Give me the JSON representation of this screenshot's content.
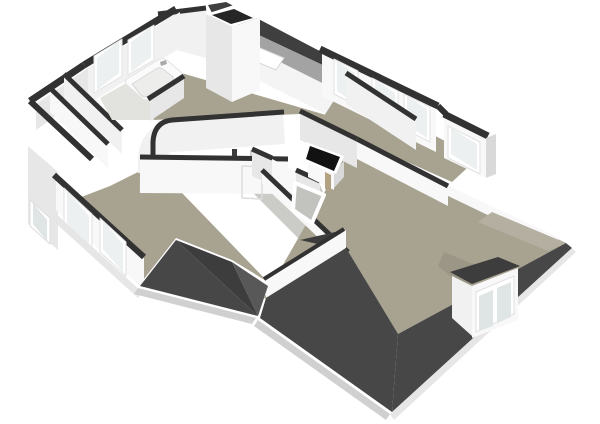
{
  "meta": {
    "view": "3d-floorplan-render",
    "storey": "attic-floor",
    "background": "#ffffff",
    "canvas": {
      "width": 600,
      "height": 424
    }
  },
  "palette": {
    "bg": "#ffffff",
    "cap": "#323232",
    "roofSliver": "#3f3f3f",
    "slopeInner": "#a3a3a3",
    "kneeWall": "#f4f4f4",
    "floor": "#a8a290",
    "floorDim": "#9c9686",
    "floorLight": "#b5afa1",
    "landingFloor": "#cbcbc8",
    "voidFill": "#c2c2bf",
    "wallBright": "#f8f8f8",
    "wallFace": "#f1f1f1",
    "wallMid": "#e7e7e7",
    "wallShade": "#d9d9d9",
    "glass": "#edf0f0",
    "glassDim": "#dfe4e4",
    "frame": "#ffffff",
    "roofA": "#474747",
    "roofB": "#3d3d3d",
    "roofC": "#585858",
    "fascia": "#d0d0d0",
    "fasciaLight": "#e6e6e6",
    "black": "#121212",
    "wood": "#b2a283",
    "bathFloor": "#e2e2df",
    "tub": "#fbfbfb",
    "tubInner": "#ededec",
    "metal": "#a9a9a9"
  },
  "scene": {
    "elements": [
      {
        "name": "roof-ridge-sliver",
        "shape": "polygon",
        "points": "208,5 226,2 354,69 346,76 212,13",
        "fill": "$roofSliver"
      },
      {
        "name": "ceiling-slope-band",
        "shape": "polygon",
        "points": "212,13 346,76 336,90 204,24",
        "fill": "$slopeInner"
      },
      {
        "name": "knee-wall",
        "shape": "polygon",
        "points": "204,24 336,90 330,116 198,50",
        "fill": "$kneeWall"
      },
      {
        "name": "skylight-window",
        "shape": "polygon",
        "points": "246,42 284,58 276,70 238,54",
        "fill": "$frame",
        "stroke": "#d5d5d5",
        "strokeWidth": 1
      },
      {
        "name": "bedroom-floor",
        "shape": "polygon",
        "points": "140,61 326,115 356,137 352,142 300,114 152,120",
        "fill": "$floor"
      },
      {
        "name": "rightwing-floor",
        "shape": "polygon",
        "points": "342,88 478,158 452,182 358,140 324,116",
        "fill": "$floor"
      },
      {
        "name": "landing-floor",
        "shape": "polygon",
        "points": "250,150 320,185 336,222 298,238 252,192",
        "fill": "$landingFloor"
      },
      {
        "name": "bottomleft-room-floor",
        "shape": "polygon",
        "points": "58,206 110,186 154,164 268,282 232,260 176,238 140,284",
        "fill": "$floor"
      },
      {
        "name": "bigroom-floor",
        "shape": "polygon",
        "points": "352,144 448,186 566,243 398,334 264,298",
        "fill": "$floor"
      },
      {
        "name": "topwing-wall-face",
        "shape": "polygon",
        "points": "162,12 206,7 206,58 162,46",
        "fill": "$wallFace"
      },
      {
        "name": "topwing-wall-cap",
        "shape": "path",
        "d": "M 158,14 L 206,8",
        "fill": "none",
        "stroke": "$cap",
        "strokeWidth": 5
      },
      {
        "name": "bath-window-wall-face",
        "shape": "polygon",
        "points": "88,68 180,12 180,48 88,104",
        "fill": "$wallFace"
      },
      {
        "name": "bath-window-wall-cap",
        "shape": "path",
        "d": "M 84,65 L 176,9",
        "fill": "none",
        "stroke": "$cap",
        "strokeWidth": 7
      },
      {
        "name": "bath-window-1-frame",
        "shape": "polygon",
        "points": "94,56 122,39 122,76 94,93",
        "fill": "$frame",
        "stroke": "#e2e2e2",
        "strokeWidth": 1
      },
      {
        "name": "bath-window-1-glass",
        "shape": "polygon",
        "points": "97,58 119,41 119,73 97,90",
        "fill": "$glass"
      },
      {
        "name": "bath-window-2-frame",
        "shape": "polygon",
        "points": "128,40 154,25 154,60 128,75",
        "fill": "$frame",
        "stroke": "#e2e2e2",
        "strokeWidth": 1
      },
      {
        "name": "bath-window-2-glass",
        "shape": "polygon",
        "points": "131,42 151,27 151,57 131,72",
        "fill": "$glass"
      },
      {
        "name": "nw-corner-wall-face",
        "shape": "polygon",
        "points": "36,104 88,68 88,94 36,130",
        "fill": "$wallMid"
      },
      {
        "name": "nw-corner-wall-cap",
        "shape": "path",
        "d": "M 30,101 L 84,65",
        "fill": "none",
        "stroke": "$cap",
        "strokeWidth": 7
      },
      {
        "name": "leftwing-outer-cap",
        "shape": "path",
        "d": "M 30,101 L 92,159",
        "fill": "none",
        "stroke": "$cap",
        "strokeWidth": 6
      },
      {
        "name": "leftwing-wall-1-face",
        "shape": "polygon",
        "points": "50,90 108,146 108,168 50,112",
        "fill": "$wallBright"
      },
      {
        "name": "leftwing-wall-1-cap",
        "shape": "path",
        "d": "M 50,88 L 108,144",
        "fill": "none",
        "stroke": "$cap",
        "strokeWidth": 5
      },
      {
        "name": "leftwing-wall-2-face",
        "shape": "polygon",
        "points": "64,76 122,132 122,154 64,98",
        "fill": "$wallFace"
      },
      {
        "name": "leftwing-wall-2-cap",
        "shape": "path",
        "d": "M 64,74 L 122,130",
        "fill": "none",
        "stroke": "$cap",
        "strokeWidth": 5
      },
      {
        "name": "left-gable-face",
        "shape": "polygon",
        "points": "28,146 58,172 58,250 28,224",
        "fill": "$wallMid"
      },
      {
        "name": "left-gable-window-frame",
        "shape": "polygon",
        "points": "30,200 50,218 50,244 30,226",
        "fill": "$frame",
        "stroke": "#dcdcdc",
        "strokeWidth": 1
      },
      {
        "name": "left-gable-window-glass",
        "shape": "polygon",
        "points": "33,203 47,220 47,241 33,224",
        "fill": "$glassDim"
      },
      {
        "name": "chimney-top-rim",
        "shape": "polygon",
        "points": "206,14 234,5 260,17 232,27",
        "fill": "$frame"
      },
      {
        "name": "chimney-shaft-opening",
        "shape": "polygon",
        "points": "212,15 234,9 253,18 231,24",
        "fill": "#262626"
      },
      {
        "name": "chimney-left-face",
        "shape": "polygon",
        "points": "206,14 232,27 232,102 206,88",
        "fill": "$wallMid"
      },
      {
        "name": "chimney-right-face",
        "shape": "polygon",
        "points": "232,27 260,17 260,90 232,102",
        "fill": "$wallBright"
      },
      {
        "name": "ne-wall-face-1",
        "shape": "polygon",
        "points": "322,54 436,110 436,152 322,96",
        "fill": "$wallBright"
      },
      {
        "name": "ne-wall-cap-1",
        "shape": "path",
        "d": "M 320,49 L 438,106",
        "fill": "none",
        "stroke": "$cap",
        "strokeWidth": 7
      },
      {
        "name": "ne-window-1-frame",
        "shape": "polygon",
        "points": "334,59 358,71 358,106 334,94",
        "fill": "$frame",
        "stroke": "#e2e2e2",
        "strokeWidth": 1
      },
      {
        "name": "ne-window-1-glass",
        "shape": "polygon",
        "points": "337,61 355,73 355,103 337,91",
        "fill": "$glass"
      },
      {
        "name": "ne-window-2-frame",
        "shape": "polygon",
        "points": "372,78 398,91 398,126 372,113",
        "fill": "$frame",
        "stroke": "#e2e2e2",
        "strokeWidth": 1
      },
      {
        "name": "ne-window-2-glass",
        "shape": "polygon",
        "points": "375,80 395,93 395,122 375,109",
        "fill": "$glass"
      },
      {
        "name": "ne-window-3-frame",
        "shape": "polygon",
        "points": "404,94 430,107 430,142 404,129",
        "fill": "$frame",
        "stroke": "#e2e2e2",
        "strokeWidth": 1
      },
      {
        "name": "ne-window-3-glass",
        "shape": "polygon",
        "points": "407,96 427,109 427,138 407,125",
        "fill": "$glass"
      },
      {
        "name": "ne-wall-jog-cap",
        "shape": "path",
        "d": "M 438,106 L 446,114",
        "fill": "none",
        "stroke": "$cap",
        "strokeWidth": 6
      },
      {
        "name": "ne-wall-face-2",
        "shape": "polygon",
        "points": "444,118 486,138 486,178 444,158",
        "fill": "$wallBright"
      },
      {
        "name": "ne-wall-cap-2",
        "shape": "path",
        "d": "M 444,114 L 488,136",
        "fill": "none",
        "stroke": "$cap",
        "strokeWidth": 7
      },
      {
        "name": "ne-window-4-frame",
        "shape": "polygon",
        "points": "448,126 480,142 480,174 448,158",
        "fill": "$frame",
        "stroke": "#e2e2e2",
        "strokeWidth": 1
      },
      {
        "name": "ne-window-4-glass",
        "shape": "polygon",
        "points": "451,128 477,144 477,170 451,154",
        "fill": "$glass"
      },
      {
        "name": "ne-end-wall-face",
        "shape": "polygon",
        "points": "486,138 496,134 496,174 486,178",
        "fill": "$wallShade"
      },
      {
        "name": "rightwing-divider-1-face",
        "shape": "polygon",
        "points": "300,113 357,141 357,168 300,140",
        "fill": "$wallMid"
      },
      {
        "name": "rightwing-divider-1-cap",
        "shape": "path",
        "d": "M 300,111 L 357,139",
        "fill": "none",
        "stroke": "$cap",
        "strokeWidth": 5
      },
      {
        "name": "rightwing-divider-2-face",
        "shape": "polygon",
        "points": "346,75 416,121 416,150 346,104",
        "fill": "$wallFace"
      },
      {
        "name": "rightwing-divider-2-cap",
        "shape": "path",
        "d": "M 346,73 L 416,119",
        "fill": "none",
        "stroke": "$cap",
        "strokeWidth": 5
      },
      {
        "name": "bigroom-north-wall-face",
        "shape": "polygon",
        "points": "357,141 448,188 448,206 357,159",
        "fill": "$wallBright"
      },
      {
        "name": "bigroom-north-wall-cap",
        "shape": "path",
        "d": "M 357,139 L 448,186",
        "fill": "none",
        "stroke": "$cap",
        "strokeWidth": 5
      },
      {
        "name": "bigroom-ne-low-wall",
        "shape": "polygon",
        "points": "448,186 560,238 552,246 444,194",
        "fill": "$wallBright"
      },
      {
        "name": "roof-right-wedge",
        "shape": "polygon",
        "points": "492,212 566,243 548,251 478,222",
        "fill": "$floorLight"
      },
      {
        "name": "corridor-wall-1-face",
        "shape": "path",
        "d": "M 284,129 L 172,137 Q 154,139 153,159 L 153,173",
        "fill": "none",
        "stroke": "$wallFace",
        "strokeWidth": 30
      },
      {
        "name": "corridor-wall-1-cap",
        "shape": "path",
        "d": "M 284,112 L 172,120 Q 154,122 153,142 L 153,156",
        "fill": "none",
        "stroke": "$cap",
        "strokeWidth": 5
      },
      {
        "name": "corridor-wall-2-face",
        "shape": "path",
        "d": "M 140,176 L 288,177",
        "fill": "none",
        "stroke": "$wallBright",
        "strokeWidth": 34
      },
      {
        "name": "corridor-wall-2-cap",
        "shape": "path",
        "d": "M 140,157 L 288,159",
        "fill": "none",
        "stroke": "$cap",
        "strokeWidth": 5
      },
      {
        "name": "corridor-door-outline",
        "shape": "polygon",
        "points": "242,166 262,167 262,199 242,198",
        "fill": "none",
        "stroke": "#dcdcdc",
        "strokeWidth": 1.5
      },
      {
        "name": "door-handle-mark",
        "shape": "polygon",
        "points": "232,149 237,149 237,156 232,156",
        "fill": "#3a3a3a"
      },
      {
        "name": "landing-nw-wall-face",
        "shape": "polygon",
        "points": "252,151 320,183 320,208 252,176",
        "fill": "$wallMid"
      },
      {
        "name": "landing-door-gap",
        "shape": "polygon",
        "points": "272,159 296,171 296,196 272,184",
        "fill": "$wallBright"
      },
      {
        "name": "landing-nw-wall-cap-a",
        "shape": "path",
        "d": "M 252,149 L 272,158",
        "fill": "none",
        "stroke": "$cap",
        "strokeWidth": 5
      },
      {
        "name": "landing-nw-wall-cap-b",
        "shape": "path",
        "d": "M 296,170 L 320,181",
        "fill": "none",
        "stroke": "$cap",
        "strokeWidth": 5
      },
      {
        "name": "landing-east-wall-face",
        "shape": "polygon",
        "points": "262,172 348,254 348,266 262,184",
        "fill": "$wallBright"
      },
      {
        "name": "landing-east-wall-cap",
        "shape": "path",
        "d": "M 262,170 L 348,252",
        "fill": "none",
        "stroke": "$cap",
        "strokeWidth": 5
      },
      {
        "name": "middle-roof-triangle",
        "shape": "polygon",
        "points": "300,240 344,250 344,230",
        "fill": "$roofB"
      },
      {
        "name": "bigroom-west-wall-face",
        "shape": "polygon",
        "points": "266,280 346,230 346,248 266,298",
        "fill": "$wallBright"
      },
      {
        "name": "bigroom-west-wall-cap",
        "shape": "path",
        "d": "M 264,279 L 344,229",
        "fill": "none",
        "stroke": "$cap",
        "strokeWidth": 4
      },
      {
        "name": "bathroom-floor",
        "shape": "polygon",
        "points": "100,98 128,82 154,104 154,120 112,120",
        "fill": "$bathFloor"
      },
      {
        "name": "bathtub-outer",
        "shape": "path",
        "d": "M 126,84 Q 124,80 130,77 L 158,60 Q 164,57 168,61 L 182,73 Q 186,77 180,81 L 152,99 Q 146,102 142,98 Z",
        "fill": "$tub",
        "stroke": "#e3e3e3",
        "strokeWidth": 1
      },
      {
        "name": "bathtub-basin",
        "shape": "path",
        "d": "M 132,84 L 156,69 Q 160,66 164,70 L 172,76 Q 175,79 171,82 L 148,96 Q 144,98 141,95 Z",
        "fill": "$tubInner",
        "stroke": "#d8d8d8",
        "strokeWidth": 1
      },
      {
        "name": "bathtub-faucet",
        "shape": "polygon",
        "points": "160,62 166,60 167,64 161,66",
        "fill": "$metal"
      },
      {
        "name": "bath-divider-face",
        "shape": "polygon",
        "points": "150,101 184,78 184,98 150,121",
        "fill": "$wallMid"
      },
      {
        "name": "bath-divider-cap",
        "shape": "path",
        "d": "M 148,99 L 184,76",
        "fill": "none",
        "stroke": "$cap",
        "strokeWidth": 5
      },
      {
        "name": "stair-hatch-front-face",
        "shape": "polygon",
        "points": "308,159 334,172 334,190 308,177",
        "fill": "$wallBright"
      },
      {
        "name": "stair-hatch-side-face",
        "shape": "polygon",
        "points": "334,172 344,161 344,177 334,188",
        "fill": "$wallShade"
      },
      {
        "name": "stair-hatch-rim",
        "shape": "polygon",
        "points": "306,142 344,156 336,174 302,160",
        "fill": "$frame"
      },
      {
        "name": "stair-hatch-opening",
        "shape": "polygon",
        "points": "310,146 340,157 334,171 306,159",
        "fill": "$black"
      },
      {
        "name": "stair-hatch-post",
        "shape": "polygon",
        "points": "325,172 331,175 331,192 325,189",
        "fill": "$wood"
      },
      {
        "name": "stair-void-frame",
        "shape": "polygon",
        "points": "295,183 324,195 312,223 293,210",
        "fill": "$voidFill",
        "stroke": "$frame",
        "strokeWidth": 4
      },
      {
        "name": "sw-window-wall-face",
        "shape": "polygon",
        "points": "56,178 144,258 144,290 56,210",
        "fill": "$wallBright"
      },
      {
        "name": "sw-window-wall-cap",
        "shape": "path",
        "d": "M 54,175 L 144,257",
        "fill": "none",
        "stroke": "$cap",
        "strokeWidth": 6
      },
      {
        "name": "sw-window-1-frame",
        "shape": "polygon",
        "points": "64,188 92,214 92,252 64,226",
        "fill": "$frame",
        "stroke": "#e0e0e0",
        "strokeWidth": 1
      },
      {
        "name": "sw-window-1-glass",
        "shape": "polygon",
        "points": "67,191 89,216 89,248 67,223",
        "fill": "$glass"
      },
      {
        "name": "sw-window-2-frame",
        "shape": "polygon",
        "points": "100,218 126,242 126,276 100,252",
        "fill": "$frame",
        "stroke": "#e0e0e0",
        "strokeWidth": 1
      },
      {
        "name": "sw-window-2-glass",
        "shape": "polygon",
        "points": "103,221 123,244 123,272 103,249",
        "fill": "$glass"
      },
      {
        "name": "sw-eave-fascia",
        "shape": "polygon",
        "points": "54,212 142,292 138,298 50,218",
        "fill": "$fasciaLight"
      },
      {
        "name": "roof-bl-facet-1",
        "shape": "polygon",
        "points": "140,286 176,240 258,316",
        "fill": "$roofA"
      },
      {
        "name": "roof-bl-facet-2",
        "shape": "polygon",
        "points": "176,240 232,262 258,316",
        "fill": "$roofB"
      },
      {
        "name": "roof-bl-facet-3",
        "shape": "polygon",
        "points": "232,262 268,286 258,316",
        "fill": "$roofC"
      },
      {
        "name": "roof-bl-fascia",
        "shape": "polygon",
        "points": "138,288 256,318 252,324 134,294",
        "fill": "$fascia"
      },
      {
        "name": "roof-sw-slope",
        "shape": "polygon",
        "points": "266,298 346,248 398,334 392,412 260,318",
        "fill": "$roofA"
      },
      {
        "name": "roof-se-slope",
        "shape": "polygon",
        "points": "398,334 566,243 572,248 392,412",
        "fill": "$roofA"
      },
      {
        "name": "roof-sw-fascia",
        "shape": "polygon",
        "points": "258,320 390,414 386,420 254,326",
        "fill": "$fascia"
      },
      {
        "name": "roof-se-fascia",
        "shape": "polygon",
        "points": "390,414 572,248 576,252 394,420",
        "fill": "$fasciaLight"
      },
      {
        "name": "dormer-floor-notch",
        "shape": "polygon",
        "points": "444,252 488,270 464,288 438,266",
        "fill": "$floorDim"
      },
      {
        "name": "dormer-roof-cap",
        "shape": "polygon",
        "points": "450,272 472,284 520,266 498,257",
        "fill": "$roofB"
      },
      {
        "name": "dormer-side-face",
        "shape": "polygon",
        "points": "452,276 472,286 472,336 452,318",
        "fill": "$wallFace"
      },
      {
        "name": "dormer-front-face",
        "shape": "polygon",
        "points": "472,286 518,268 518,320 472,338",
        "fill": "$wallBright"
      },
      {
        "name": "dormer-window-frame",
        "shape": "polygon",
        "points": "476,292 514,276 514,314 476,332",
        "fill": "$frame",
        "stroke": "#e0e0e0",
        "strokeWidth": 1
      },
      {
        "name": "dormer-window-glass-1",
        "shape": "polygon",
        "points": "479,296 493,290 493,326 479,331",
        "fill": "$glassDim"
      },
      {
        "name": "dormer-window-glass-2",
        "shape": "polygon",
        "points": "497,288 511,282 511,317 497,323",
        "fill": "$glassDim"
      }
    ]
  }
}
